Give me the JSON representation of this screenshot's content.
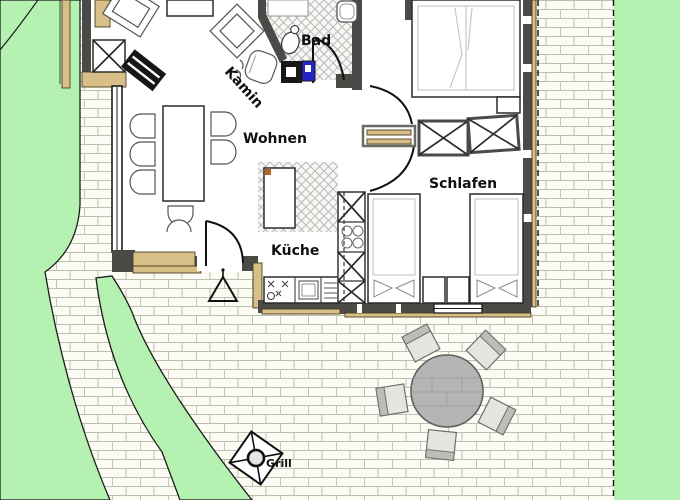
{
  "plan_labels": {
    "living_room": "Wohnen",
    "bathroom": "Bad",
    "kitchen": "Küche",
    "bedroom": "Schlafen",
    "fireplace": "Kamin",
    "grill": "Grill"
  },
  "colors": {
    "lawn": "#b5f1b1",
    "wall": "#4a4a46",
    "wood": "#d7bf87",
    "flue": "#2424c4",
    "patio-table": "#b5b5b5"
  }
}
